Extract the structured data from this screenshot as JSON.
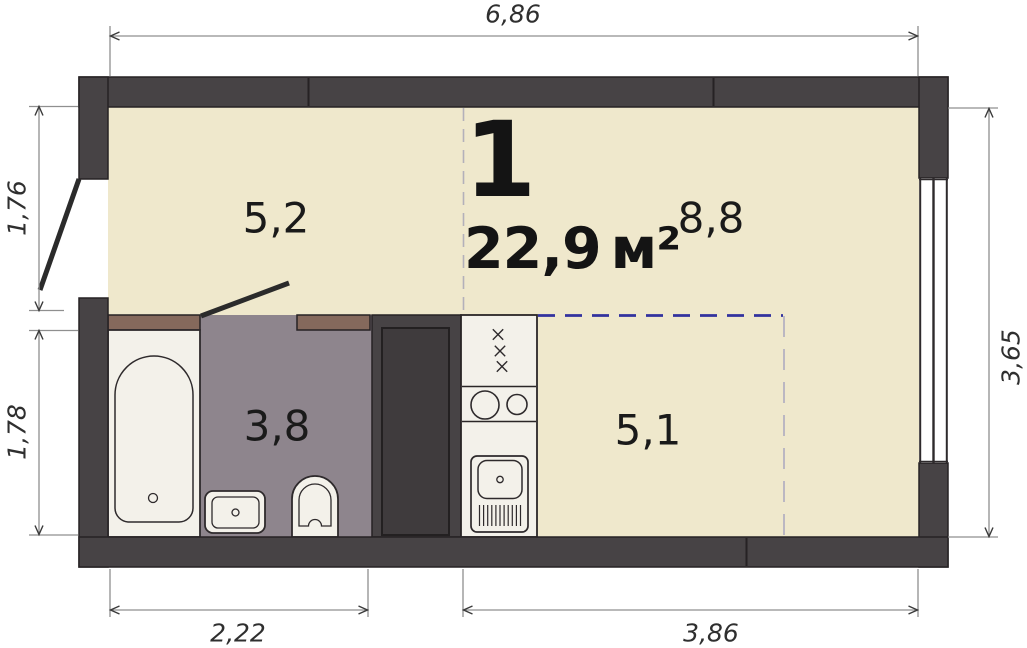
{
  "unit": {
    "number": "1",
    "area_value": "22,9",
    "area_unit": "м²"
  },
  "room_areas": {
    "living_left": "5,2",
    "living_right": "8,8",
    "bathroom": "3,8",
    "kitchen": "5,1"
  },
  "dimensions": {
    "top": "6,86",
    "left_upper": "1,76",
    "left_lower": "1,78",
    "right": "3,65",
    "bottom_left": "2,22",
    "bottom_right": "3,86"
  },
  "fixtures": [
    "bathtub",
    "bathroom-sink",
    "toilet",
    "wardrobe",
    "stove",
    "kitchen-sink",
    "window",
    "entry-door",
    "bathroom-door"
  ],
  "colors": {
    "wall": "#474345",
    "floor": "#efe8cc",
    "wet_floor": "#8e858d",
    "lintel_brown": "#85695c",
    "fixture_white": "#f3f1ea",
    "outline": "#262224",
    "zone_dash_blue": "#32329e",
    "zone_dash_gray": "#aeabc0",
    "dim_line": "#8f8f8f",
    "dim_text": "#2f2f2f"
  }
}
